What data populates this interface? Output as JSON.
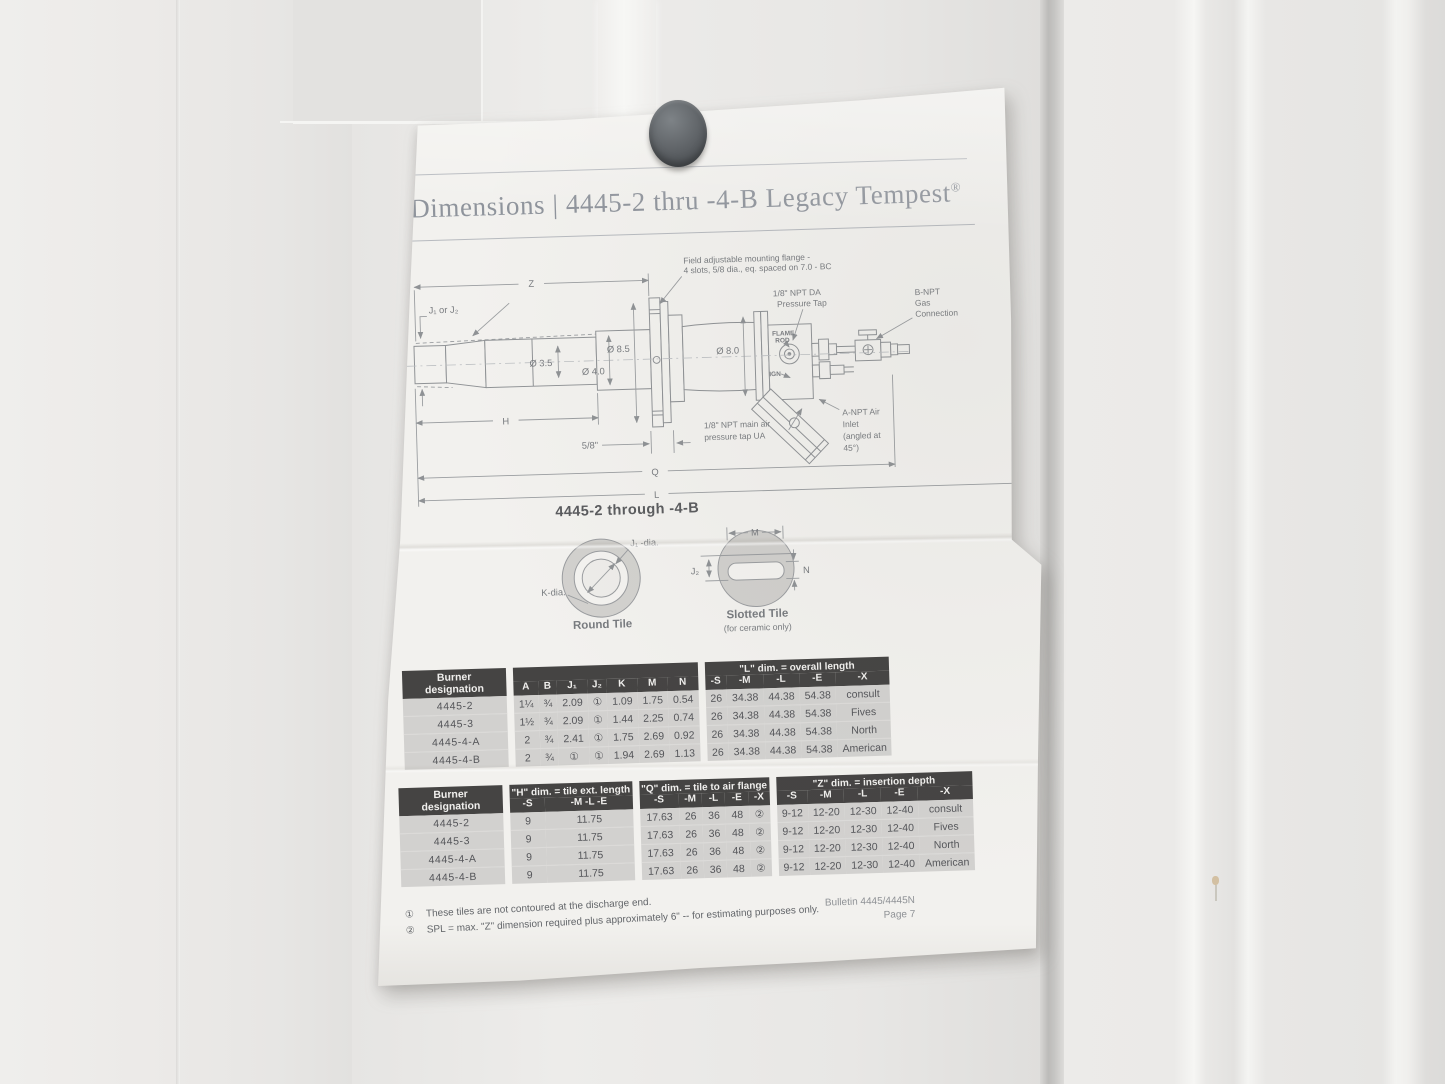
{
  "page": {
    "title": "Dimensions | 4445-2 thru -4-B Legacy Tempest",
    "trademark": "®"
  },
  "drawing": {
    "subtitle": "4445-2 through -4-B",
    "labels": {
      "z": "Z",
      "h": "H",
      "q": "Q",
      "l": "L",
      "j1_or_j2": "J₁ or J₂",
      "dia_35": "Ø 3.5",
      "dia_40": "Ø 4.0",
      "dia_85": "Ø 8.5",
      "dia_80": "Ø 8.0",
      "five_eighths": "5/8\"",
      "flange_line1": "Field adjustable mounting flange -",
      "flange_line2": "4 slots, 5/8 dia., eq. spaced on 7.0 - BC",
      "da_tap_line1": "1/8\" NPT DA",
      "da_tap_line2": "Pressure Tap",
      "gas_line1": "B-NPT",
      "gas_line2": "Gas",
      "gas_line3": "Connection",
      "flame_rod_line1": "FLAME",
      "flame_rod_line2": "ROD",
      "ign": "IGN",
      "ua_tap_line1": "1/8\" NPT main air",
      "ua_tap_line2": "pressure tap UA",
      "air_inlet_line1": "A-NPT Air",
      "air_inlet_line2": "Inlet",
      "air_inlet_line3": "(angled at",
      "air_inlet_line4": "45°)"
    }
  },
  "tiles": {
    "round": {
      "label_j1": "J₁ -dia.",
      "label_k": "K-dia.",
      "caption": "Round Tile"
    },
    "slotted": {
      "label_m": "M",
      "label_j2": "J₂",
      "label_n": "N",
      "caption": "Slotted Tile",
      "subcaption": "(for ceramic only)"
    }
  },
  "tables": [
    {
      "corner_line1": "Burner",
      "corner_line2": "designation",
      "groups": [
        {
          "label": "",
          "cols": [
            "A",
            "B",
            "J₁",
            "J₂",
            "K",
            "M",
            "N"
          ]
        },
        {
          "label": "\"L\" dim. = overall length",
          "cols": [
            "-S",
            "-M",
            "-L",
            "-E",
            "-X"
          ]
        }
      ],
      "rows": [
        [
          "4445-2",
          "1¼",
          "¾",
          "2.09",
          "①",
          "1.09",
          "1.75",
          "0.54",
          "26",
          "34.38",
          "44.38",
          "54.38",
          "consult"
        ],
        [
          "4445-3",
          "1½",
          "¾",
          "2.09",
          "①",
          "1.44",
          "2.25",
          "0.74",
          "26",
          "34.38",
          "44.38",
          "54.38",
          "Fives"
        ],
        [
          "4445-4-A",
          "2",
          "¾",
          "2.41",
          "①",
          "1.75",
          "2.69",
          "0.92",
          "26",
          "34.38",
          "44.38",
          "54.38",
          "North"
        ],
        [
          "4445-4-B",
          "2",
          "¾",
          "①",
          "①",
          "1.94",
          "2.69",
          "1.13",
          "26",
          "34.38",
          "44.38",
          "54.38",
          "American"
        ]
      ]
    },
    {
      "corner_line1": "Burner",
      "corner_line2": "designation",
      "groups": [
        {
          "label": "\"H\" dim. = tile ext. length",
          "cols": [
            "-S",
            "-M -L -E"
          ]
        },
        {
          "label": "\"Q\" dim. = tile to air flange",
          "cols": [
            "-S",
            "-M",
            "-L",
            "-E",
            "-X"
          ]
        },
        {
          "label": "\"Z\" dim. = insertion depth",
          "cols": [
            "-S",
            "-M",
            "-L",
            "-E",
            "-X"
          ]
        }
      ],
      "rows": [
        [
          "4445-2",
          "9",
          "11.75",
          "17.63",
          "26",
          "36",
          "48",
          "②",
          "9-12",
          "12-20",
          "12-30",
          "12-40",
          "consult"
        ],
        [
          "4445-3",
          "9",
          "11.75",
          "17.63",
          "26",
          "36",
          "48",
          "②",
          "9-12",
          "12-20",
          "12-30",
          "12-40",
          "Fives"
        ],
        [
          "4445-4-A",
          "9",
          "11.75",
          "17.63",
          "26",
          "36",
          "48",
          "②",
          "9-12",
          "12-20",
          "12-30",
          "12-40",
          "North"
        ],
        [
          "4445-4-B",
          "9",
          "11.75",
          "17.63",
          "26",
          "36",
          "48",
          "②",
          "9-12",
          "12-20",
          "12-30",
          "12-40",
          "American"
        ]
      ]
    }
  ],
  "footnotes": [
    {
      "marker": "①",
      "text": "These tiles are not contoured at the discharge end."
    },
    {
      "marker": "②",
      "text": "SPL = max. \"Z\" dimension required plus approximately 6\" -- for estimating purposes only."
    }
  ],
  "bulletin": {
    "line1": "Bulletin 4445/4445N",
    "line2": "Page 7"
  }
}
